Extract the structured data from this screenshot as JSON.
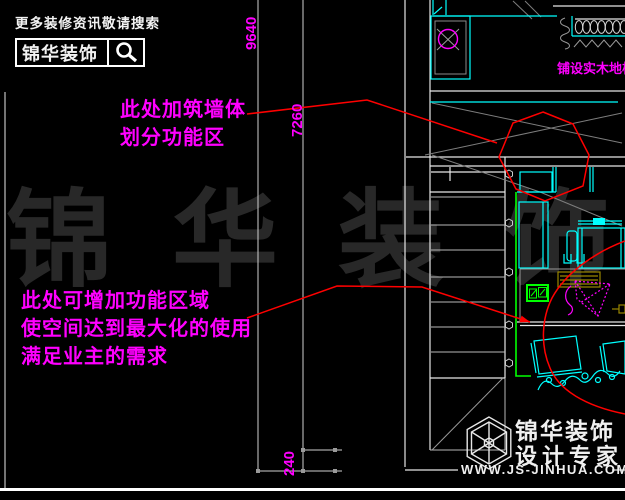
{
  "header": {
    "tagline": "更多装修资讯敬请搜索",
    "brand": "锦华装饰"
  },
  "dimensions": {
    "total_height": "9640",
    "inner_height": "7260",
    "wall_thickness": "240"
  },
  "annotations": {
    "wall_note": [
      "此处加筑墙体",
      "划分功能区"
    ],
    "function_note": [
      "此处可增加功能区域",
      "使空间达到最大化的使用",
      "满足业主的需求"
    ],
    "floor_label": "铺设实木地板"
  },
  "watermark": "锦华装饰",
  "footer": {
    "brand": "锦华装饰",
    "subtitle": "设计专家",
    "website": "WWW.JS-JINHUA.COM"
  },
  "colors": {
    "annotation_magenta": "#ff00ff",
    "highlight_red": "#ff0000",
    "cad_cyan": "#00ffff",
    "cad_green": "#00ff00",
    "cad_olive": "#9a8700",
    "line_white": "#ffffff",
    "watermark_gray": "#282828"
  }
}
